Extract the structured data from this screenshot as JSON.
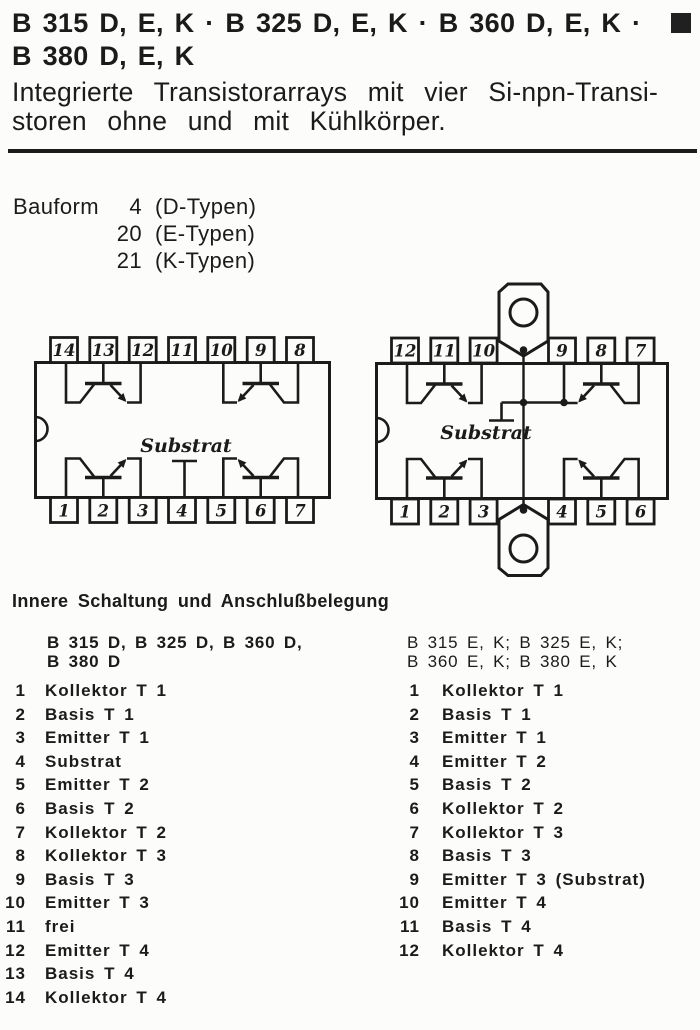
{
  "header": {
    "title_line1": "B 315 D, E, K · B 325 D, E, K · B 360 D, E, K ·",
    "title_line2": "B 380 D, E, K",
    "subtitle_line1": "Integrierte Transistorarrays mit vier Si-npn-Transi-",
    "subtitle_line2": "storen ohne und mit Kühlkörper."
  },
  "bauform": {
    "label": "Bauform",
    "rows": [
      {
        "num": "4",
        "text": "(D-Typen)"
      },
      {
        "num": "20",
        "text": "(E-Typen)"
      },
      {
        "num": "21",
        "text": "(K-Typen)"
      }
    ]
  },
  "diagrams": {
    "dip14": {
      "top_pins": [
        "14",
        "13",
        "12",
        "11",
        "10",
        "9",
        "8"
      ],
      "bottom_pins": [
        "1",
        "2",
        "3",
        "4",
        "5",
        "6",
        "7"
      ],
      "substrat_label": "Substrat"
    },
    "dip12k": {
      "top_pins": [
        "12",
        "11",
        "10",
        "9",
        "8",
        "7"
      ],
      "bottom_pins": [
        "1",
        "2",
        "3",
        "4",
        "5",
        "6"
      ],
      "substrat_label": "Substrat"
    }
  },
  "pinout": {
    "heading": "Innere Schaltung und Anschlußbelegung",
    "left_column": {
      "header_line1": "B 315 D, B 325 D, B 360 D,",
      "header_line2": "B 380 D",
      "pins": [
        {
          "num": "1",
          "label": "Kollektor T 1"
        },
        {
          "num": "2",
          "label": "Basis T 1"
        },
        {
          "num": "3",
          "label": "Emitter T 1"
        },
        {
          "num": "4",
          "label": "Substrat"
        },
        {
          "num": "5",
          "label": "Emitter T 2"
        },
        {
          "num": "6",
          "label": "Basis T 2"
        },
        {
          "num": "7",
          "label": "Kollektor T 2"
        },
        {
          "num": "8",
          "label": "Kollektor T 3"
        },
        {
          "num": "9",
          "label": "Basis T 3"
        },
        {
          "num": "10",
          "label": "Emitter T 3"
        },
        {
          "num": "11",
          "label": "frei"
        },
        {
          "num": "12",
          "label": "Emitter T 4"
        },
        {
          "num": "13",
          "label": "Basis T 4"
        },
        {
          "num": "14",
          "label": "Kollektor T 4"
        }
      ]
    },
    "right_column": {
      "header_line1": "B 315 E, K; B 325 E, K;",
      "header_line2": "B 360 E, K; B 380 E, K",
      "pins": [
        {
          "num": "1",
          "label": "Kollektor T 1"
        },
        {
          "num": "2",
          "label": "Basis T 1"
        },
        {
          "num": "3",
          "label": "Emitter T 1"
        },
        {
          "num": "4",
          "label": "Emitter T 2"
        },
        {
          "num": "5",
          "label": "Basis T 2"
        },
        {
          "num": "6",
          "label": "Kollektor T 2"
        },
        {
          "num": "7",
          "label": "Kollektor T 3"
        },
        {
          "num": "8",
          "label": "Basis T 3"
        },
        {
          "num": "9",
          "label": "Emitter T 3 (Substrat)"
        },
        {
          "num": "10",
          "label": "Emitter T 4"
        },
        {
          "num": "11",
          "label": "Basis T 4"
        },
        {
          "num": "12",
          "label": "Kollektor T 4"
        }
      ]
    }
  },
  "colors": {
    "ink": "#1b1b1b",
    "paper": "#fcfcfa"
  }
}
